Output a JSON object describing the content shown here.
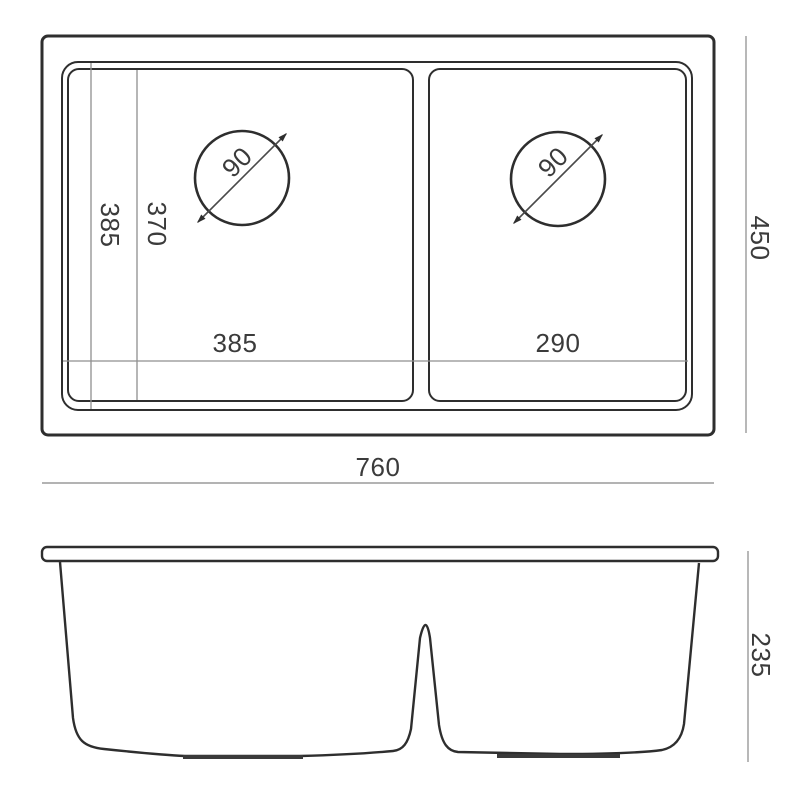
{
  "drawing": {
    "type": "sink-technical-drawing",
    "colors": {
      "outline": "#2e2e2e",
      "dimension_line": "#9a9a9a",
      "text": "#3b3b3b",
      "background": "#ffffff"
    },
    "top_view": {
      "overall_width_mm": "760",
      "overall_depth_mm": "450",
      "left_bowl_width_mm": "385",
      "right_bowl_width_mm": "290",
      "outer_bowl_depth_mm": "385",
      "inner_bowl_depth_mm": "370",
      "left_drain_diameter_mm": "90",
      "right_drain_diameter_mm": "90"
    },
    "front_view": {
      "bowl_height_mm": "235"
    }
  }
}
